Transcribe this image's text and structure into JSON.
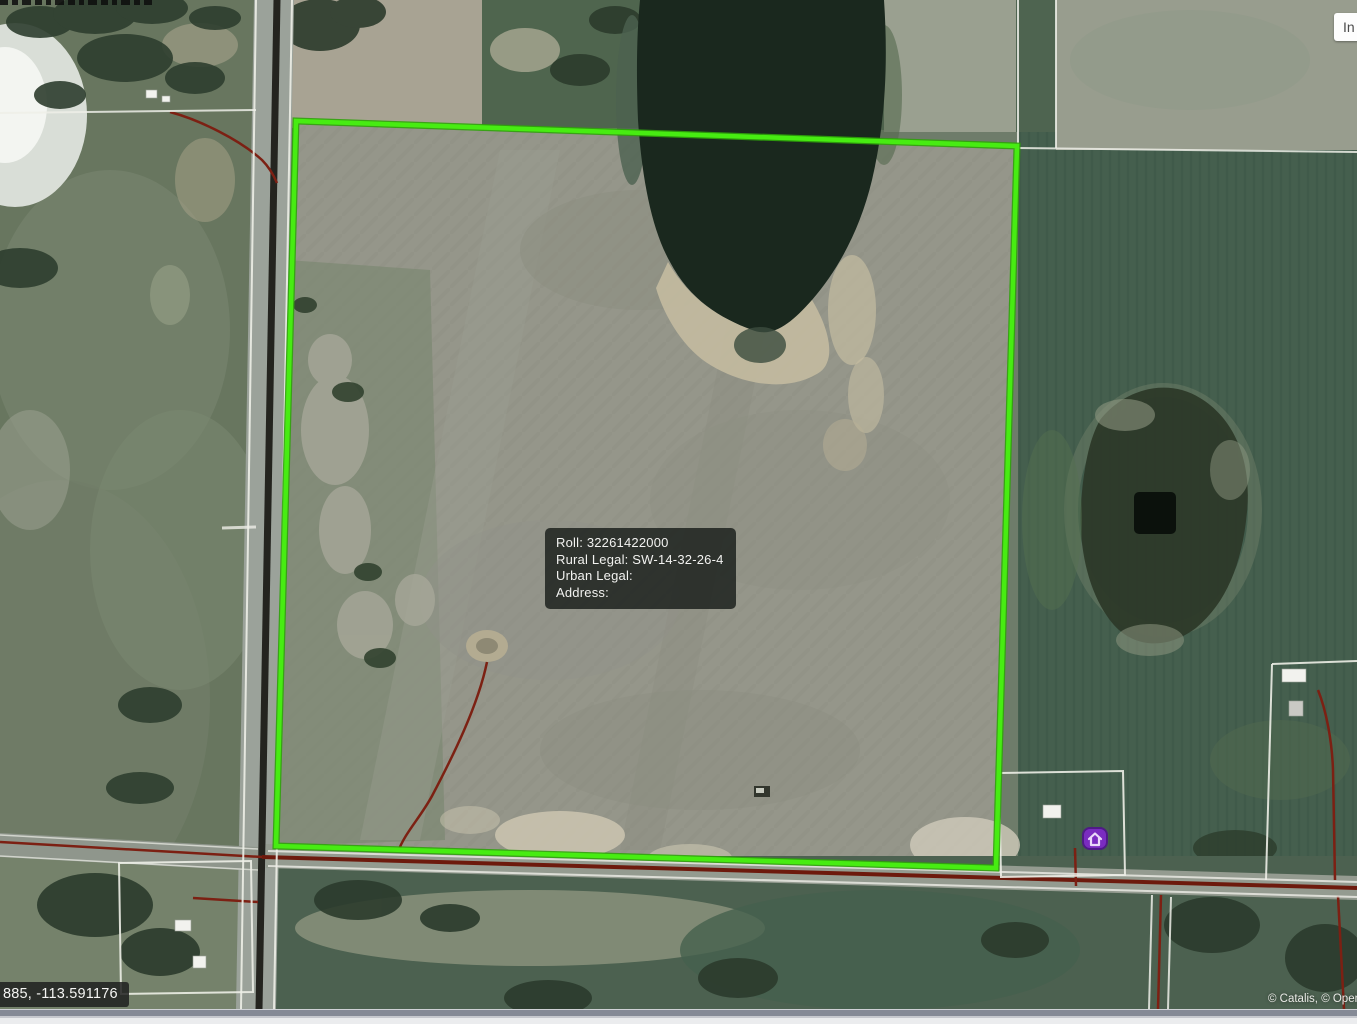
{
  "tooltip": {
    "roll": "Roll: 32261422000",
    "rural_legal": "Rural Legal: SW-14-32-26-4",
    "urban_legal": "Urban Legal:",
    "address": "Address:"
  },
  "statusbar": {
    "coordinates": "885, -113.591176",
    "attribution": "© Catalis, © Open"
  },
  "toolbar": {
    "info_button_label": "In"
  },
  "map": {
    "layer": "aerial-imagery",
    "colors": {
      "parcel_boundary_green": "#47ec12",
      "road_red": "#6d1a0d",
      "cadastral_line_white": "#edeee7",
      "residence_marker_purple": "#7a2cc0",
      "tooltip_background": "#262a26"
    }
  }
}
